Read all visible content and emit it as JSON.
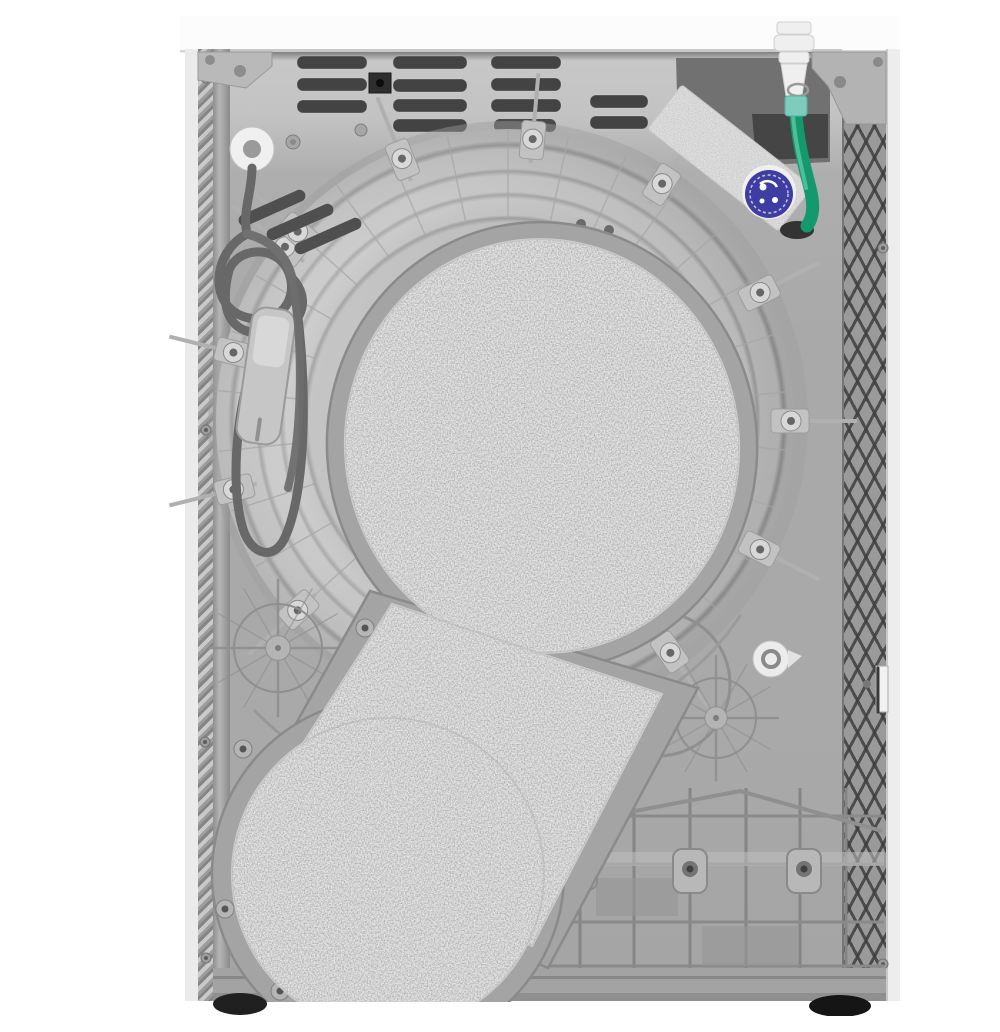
{
  "meta": {
    "subject": "Rear view of a white freestanding condenser tumble dryer on a white studio background",
    "view": "back panel facing viewer"
  },
  "appliance": {
    "cabinet": {
      "worktop": "white top panel",
      "side_panels": "white side panels",
      "back_panel": "grey moulded plastic rear panel"
    },
    "features": [
      {
        "name": "ventilation-slots",
        "desc": "Groups of horizontal cooling slots along the top of the back panel"
      },
      {
        "name": "power-cord",
        "desc": "Grey mains cable coiled and hooked on the upper-left back panel"
      },
      {
        "name": "mains-plug",
        "desc": "Grey moulded mains plug hanging inside the cable coil"
      },
      {
        "name": "cable-grommet",
        "desc": "White cable entry grommet, top left"
      },
      {
        "name": "drain-hose",
        "desc": "Green condensate drain hose with white connector, top right, entering the panel"
      },
      {
        "name": "rating-plate",
        "desc": "Silver angled rating-plate sticker, top right"
      },
      {
        "name": "energy-sticker",
        "desc": "Round dark-blue sticker on the corner of the rating plate"
      },
      {
        "name": "drum-housing",
        "desc": "Large circular rear drum housing with concentric rings, radial ribs and screw bosses"
      },
      {
        "name": "insulation-pad",
        "desc": "Speckled grey felt insulation pad, keyhole shaped, covering drum centre and belt duct"
      },
      {
        "name": "belt-duct",
        "desc": "Diagonal duct running down-left to a circular lower cover"
      },
      {
        "name": "base-moulding",
        "desc": "Ribbed plastic base section with screw tabs, lower right"
      },
      {
        "name": "adjustable-feet",
        "desc": "Two dark levelling feet under the cabinet"
      },
      {
        "name": "side-lattice",
        "desc": "Cross-hatched stiffening lattice along the right edge"
      }
    ]
  },
  "palette": {
    "background": "#ffffff",
    "cabinet_white": "#fcfcfc",
    "panel_grey": "#ababab",
    "ring_grey": "#c6c6c6",
    "pad_light": "#e4e4e4",
    "pad_speckle": "#6b6b6b",
    "slot_dark": "#434343",
    "hose_green": "#13996d",
    "hose_collar": "#7ccdbb",
    "sticker_blue": "#3e3ea2",
    "foot_dark": "#1c1c1c"
  }
}
